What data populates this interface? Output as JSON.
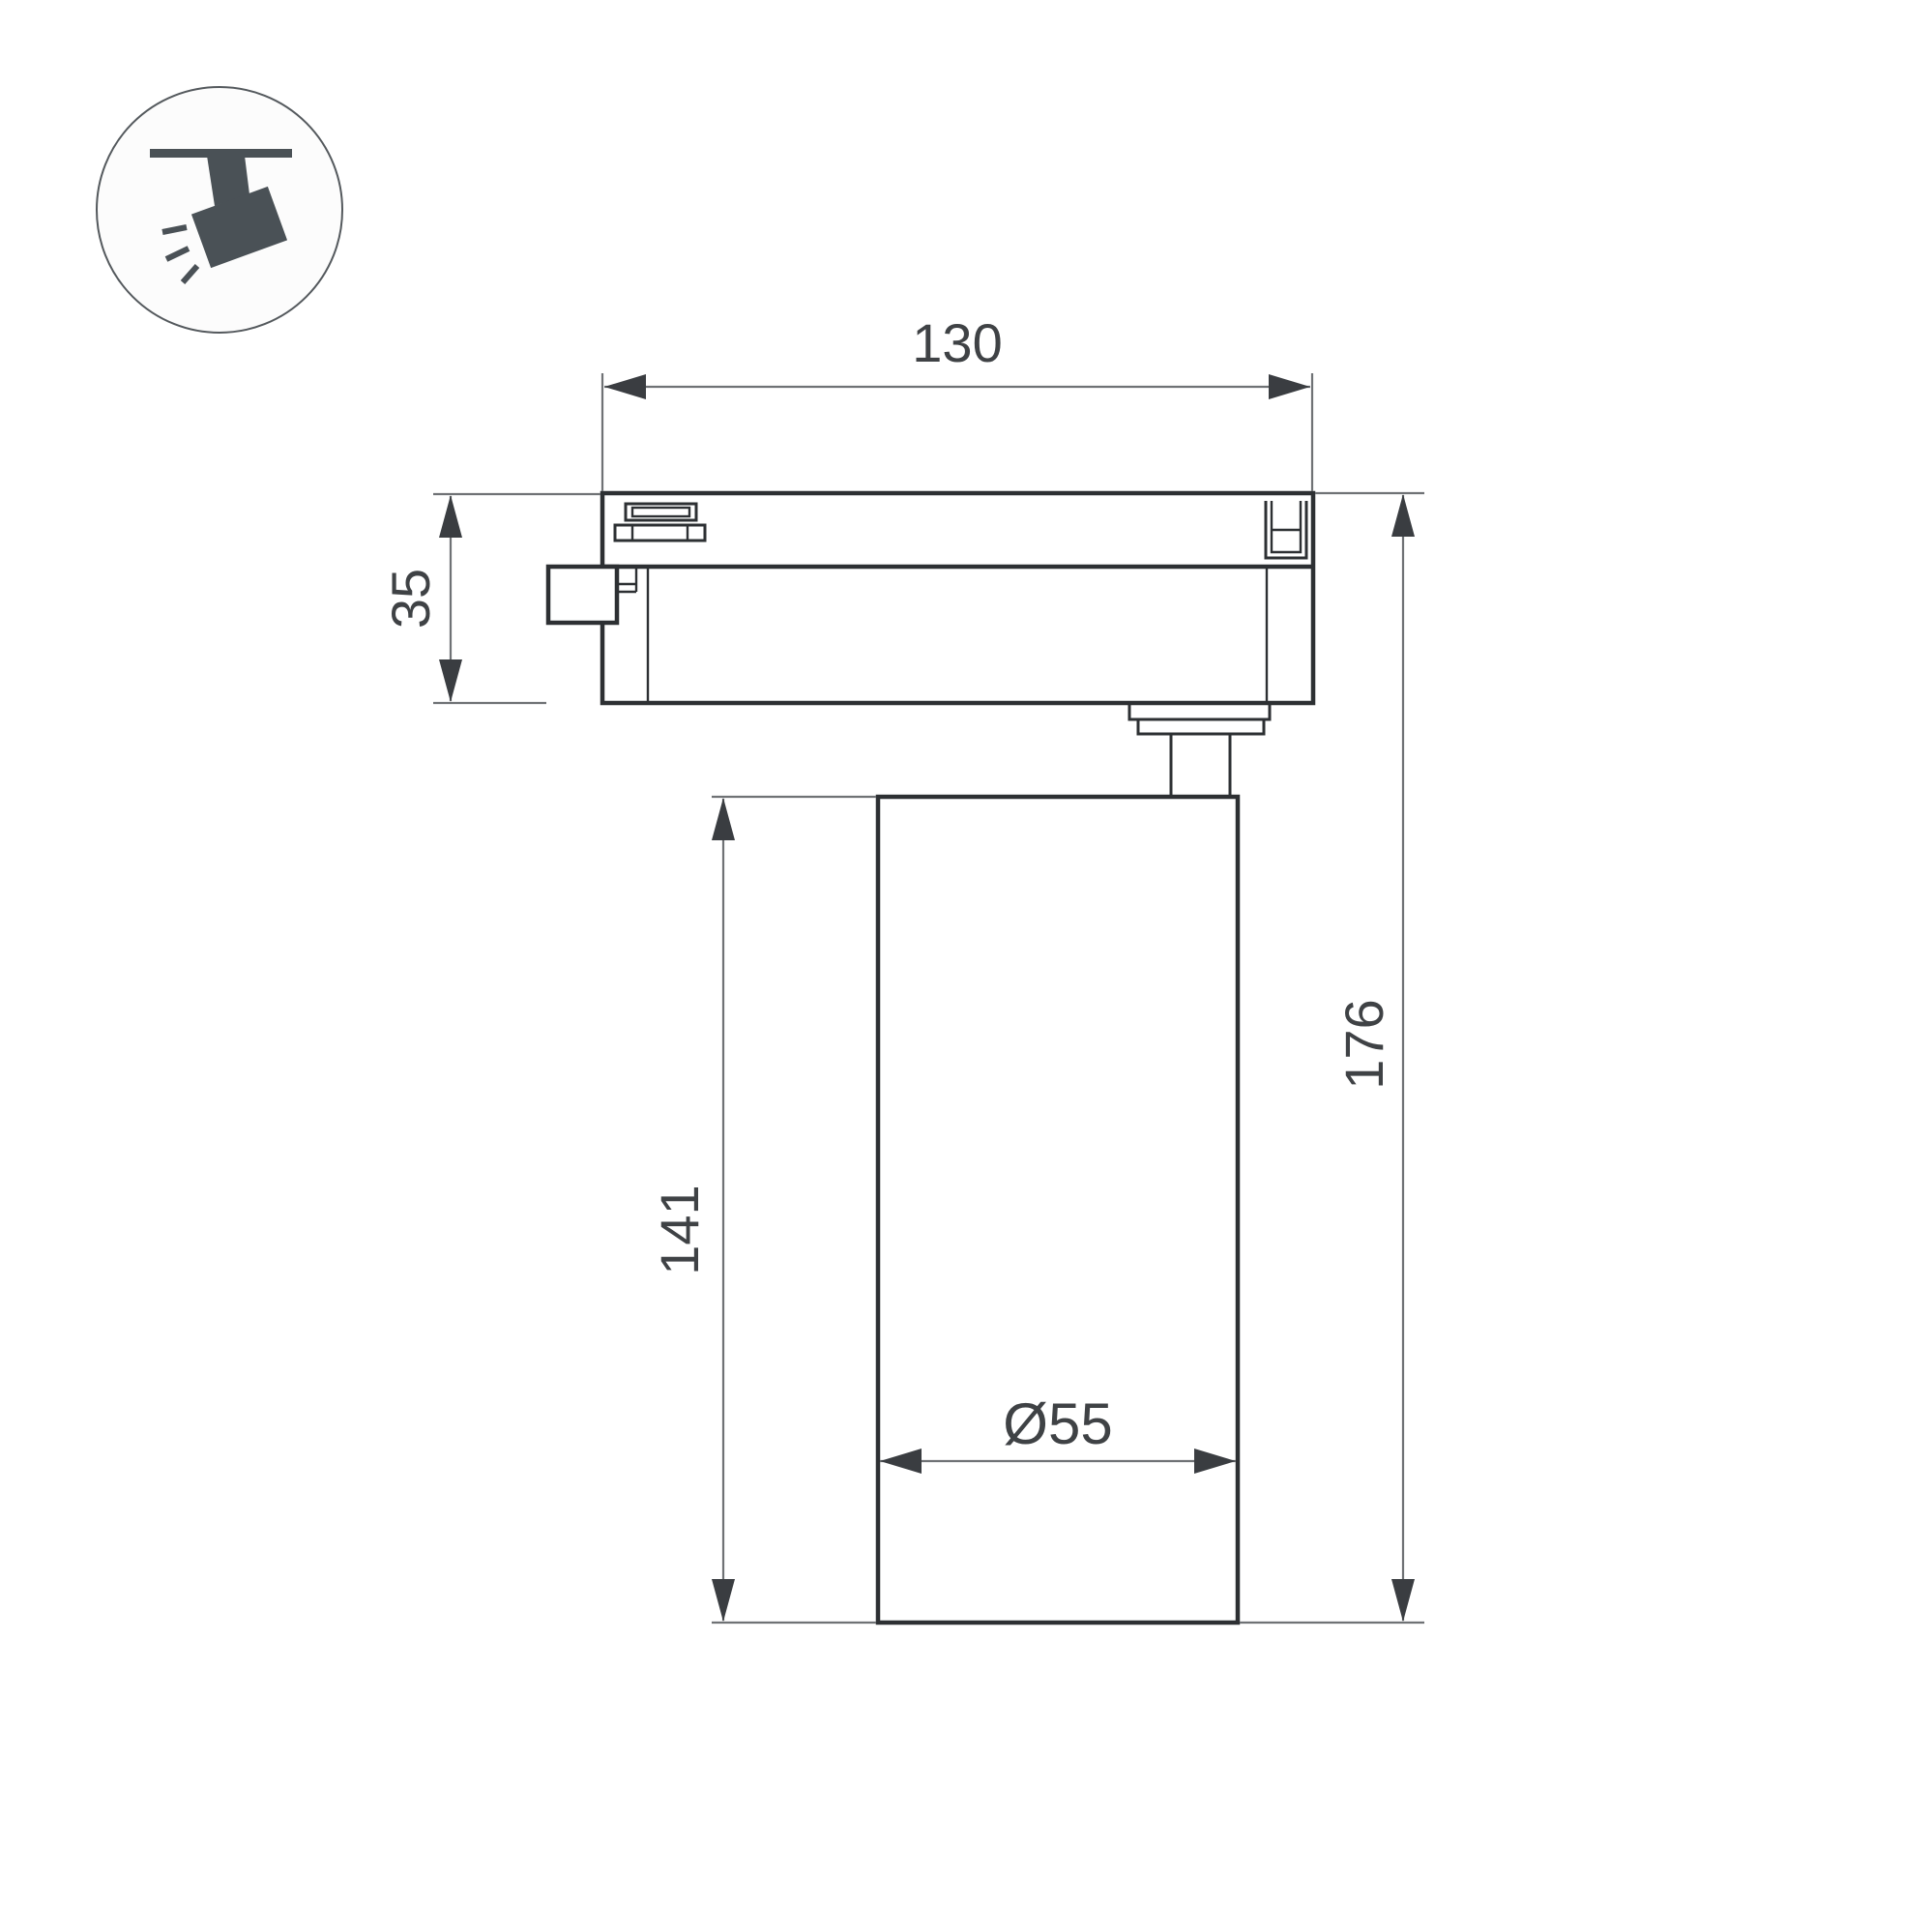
{
  "page": {
    "background": "#ffffff",
    "kind": "technical dimension drawing"
  },
  "icon": {
    "name": "track-spotlight-icon",
    "description": "ceiling track mounted spotlight pictogram"
  },
  "drawing": {
    "object": "track light fixture side view",
    "dimensions": {
      "track_width": {
        "label": "130"
      },
      "adapter_height": {
        "label": "35"
      },
      "body_height": {
        "label": "141"
      },
      "total_height": {
        "label": "176"
      },
      "body_diameter": {
        "label": "Ø55"
      }
    }
  },
  "colors": {
    "outline_dark": "#2d3033",
    "dim_line_gray": "#6f7275",
    "arrow_dark": "#3a3d41",
    "text_gray": "#3f4245",
    "icon_slate": "#4a5156",
    "background": "#ffffff"
  }
}
